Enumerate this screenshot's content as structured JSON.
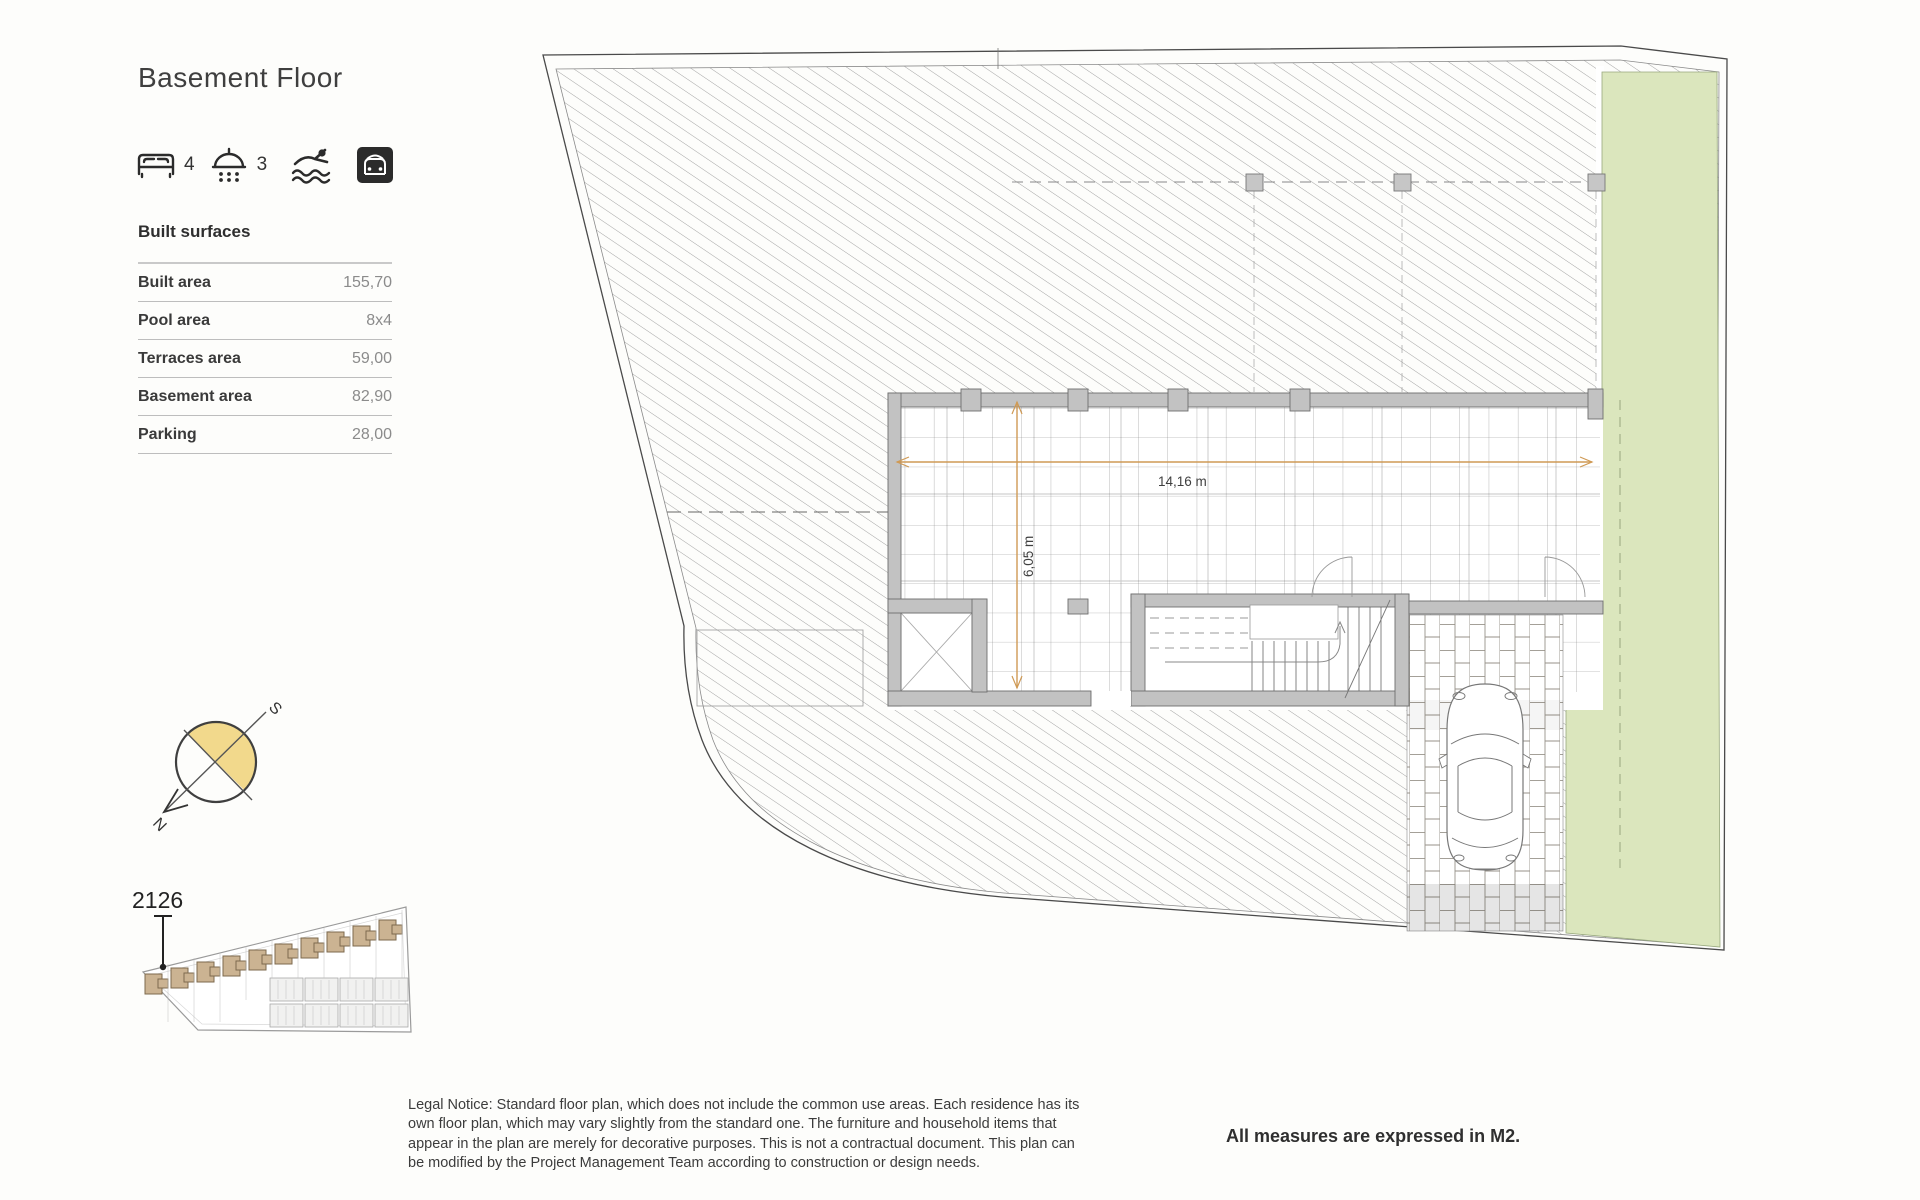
{
  "header": {
    "title": "Basement Floor"
  },
  "amenities": {
    "bedrooms": "4",
    "bathrooms": "3",
    "icons": [
      "bed-icon",
      "shower-icon",
      "pool-icon",
      "garage-icon"
    ]
  },
  "surfaces": {
    "heading": "Built surfaces",
    "rows": [
      {
        "label": "Built area",
        "value": "155,70"
      },
      {
        "label": "Pool area",
        "value": "8x4"
      },
      {
        "label": "Terraces area",
        "value": "59,00"
      },
      {
        "label": "Basement area",
        "value": "82,90"
      },
      {
        "label": "Parking",
        "value": "28,00"
      }
    ]
  },
  "compass": {
    "north_label": "N",
    "south_label": "S",
    "highlight_color": "#f2d98c"
  },
  "site_key": {
    "unit_number": "2126"
  },
  "plan": {
    "dimensions": {
      "width_label": "14,16 m",
      "height_label": "6,05 m"
    },
    "colors": {
      "garden_green": "#dbe6bd",
      "wall_grey": "#c2c2c2",
      "hatch_grey": "#9a9a9a",
      "dimension_orange": "#cf9a55"
    }
  },
  "footer": {
    "legal_lines": [
      "Legal Notice: Standard floor plan, which does not include the common use areas. Each residence has its",
      "own floor plan, which may vary slightly from the standard one. The furniture and household items that",
      "appear in the plan are merely for decorative purposes. This is not a contractual document. This plan can",
      "be modified by the Project Management Team according to construction or design needs."
    ],
    "measures_note": "All measures are expressed in M2."
  }
}
